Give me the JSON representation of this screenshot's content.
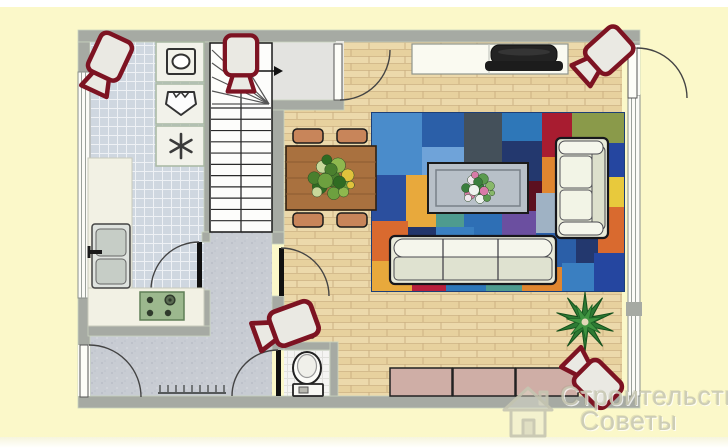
{
  "watermark": {
    "line1": "Строительство",
    "line2": "Советы"
  },
  "colors": {
    "page": "#fbf8c9",
    "wall": "#a6aaa3",
    "wall_edge": "#c9d4bf",
    "camera_outline": "#7d1322",
    "camera_fill": "#eae9e3",
    "wood_base": "#ecd9ab",
    "tile_base": "#cfd7e0",
    "hall_base": "#c8ccd3"
  },
  "plan": {
    "rooms": [
      "kitchen",
      "staircase",
      "entry-landing",
      "hallway",
      "wc",
      "living-room"
    ],
    "appliance_icons": [
      "washing-machine-icon",
      "sink-basin-icon",
      "freezer-icon"
    ],
    "cameras": [
      {
        "x": 107,
        "y": 63,
        "rot": 25,
        "scale": 1
      },
      {
        "x": 241,
        "y": 62,
        "rot": 0,
        "scale": 0.95
      },
      {
        "x": 604,
        "y": 55,
        "rot": 48,
        "scale": 1
      },
      {
        "x": 287,
        "y": 326,
        "rot": 70,
        "scale": 1.05
      },
      {
        "x": 593,
        "y": 379,
        "rot": 135,
        "scale": 1
      }
    ],
    "rug": {
      "x": 372,
      "y": 113,
      "w": 252,
      "h": 178,
      "base": "#2e6fb5",
      "border": "#1d3f77",
      "patches": [
        [
          0,
          0,
          50,
          62,
          "#4a8ccb"
        ],
        [
          50,
          0,
          42,
          34,
          "#2b5fa8"
        ],
        [
          92,
          0,
          38,
          50,
          "#44505a"
        ],
        [
          130,
          0,
          40,
          28,
          "#2e77b8"
        ],
        [
          170,
          0,
          30,
          44,
          "#a81c30"
        ],
        [
          200,
          0,
          52,
          30,
          "#8a9a4a"
        ],
        [
          200,
          30,
          26,
          40,
          "#1f63c4"
        ],
        [
          226,
          30,
          26,
          34,
          "#2546a0"
        ],
        [
          50,
          34,
          42,
          36,
          "#6fa3d9"
        ],
        [
          130,
          28,
          40,
          40,
          "#23386e"
        ],
        [
          92,
          50,
          38,
          34,
          "#c23454"
        ],
        [
          0,
          62,
          34,
          46,
          "#2b4f9e"
        ],
        [
          34,
          62,
          30,
          52,
          "#e8a93c"
        ],
        [
          64,
          70,
          28,
          44,
          "#4e9b8f"
        ],
        [
          170,
          44,
          30,
          36,
          "#e0862f"
        ],
        [
          226,
          64,
          26,
          30,
          "#e8c93c"
        ],
        [
          200,
          70,
          26,
          44,
          "#3fa3b8"
        ],
        [
          130,
          68,
          40,
          30,
          "#5c1020"
        ],
        [
          92,
          84,
          38,
          40,
          "#2e6fb5"
        ],
        [
          0,
          108,
          36,
          40,
          "#d96a2f"
        ],
        [
          36,
          114,
          28,
          36,
          "#22356b"
        ],
        [
          64,
          114,
          38,
          40,
          "#3a7fc1"
        ],
        [
          102,
          124,
          34,
          30,
          "#8aa03c"
        ],
        [
          130,
          98,
          34,
          40,
          "#6b4fa0"
        ],
        [
          164,
          80,
          36,
          40,
          "#9fb2c4"
        ],
        [
          164,
          120,
          40,
          34,
          "#2b5fa8"
        ],
        [
          226,
          94,
          26,
          46,
          "#d96a2f"
        ],
        [
          204,
          114,
          22,
          36,
          "#23386e"
        ],
        [
          0,
          148,
          40,
          30,
          "#e8a93c"
        ],
        [
          40,
          150,
          34,
          28,
          "#b81f3c"
        ],
        [
          74,
          154,
          40,
          24,
          "#2e77b8"
        ],
        [
          114,
          154,
          36,
          24,
          "#4e9b8f"
        ],
        [
          150,
          154,
          40,
          24,
          "#e0862f"
        ],
        [
          190,
          150,
          32,
          28,
          "#3a7fc1"
        ],
        [
          222,
          140,
          30,
          38,
          "#2546a0"
        ]
      ]
    },
    "stairs": {
      "x": 210,
      "y": 43,
      "w": 62,
      "h": 189,
      "tread_start": 108,
      "tread_step": 11.27,
      "tread_count": 12,
      "fan_point": [
        269,
        104
      ],
      "fan_targets": [
        [
          212,
          50
        ],
        [
          212,
          63
        ],
        [
          212,
          77
        ],
        [
          212,
          91
        ],
        [
          212,
          104
        ],
        [
          232,
          44
        ]
      ],
      "arrow": {
        "x1": 244,
        "y": 71,
        "x2": 274
      }
    },
    "chairs": {
      "w": 30,
      "h": 14,
      "fill": "#c8855a",
      "positions": [
        [
          293,
          129
        ],
        [
          337,
          129
        ],
        [
          293,
          213
        ],
        [
          337,
          213
        ]
      ]
    },
    "bench": {
      "x": 390,
      "y": 368,
      "w": 63,
      "h": 28,
      "count": 3,
      "fill": "#cfaea6"
    },
    "radiator": {
      "x": 158,
      "y": 393,
      "len": 68,
      "ticks": 9,
      "step": 8
    },
    "plants": {
      "dining_center": [
        331,
        178
      ],
      "bouquet_center": [
        478,
        188
      ],
      "palm_center": [
        585,
        322
      ]
    }
  }
}
